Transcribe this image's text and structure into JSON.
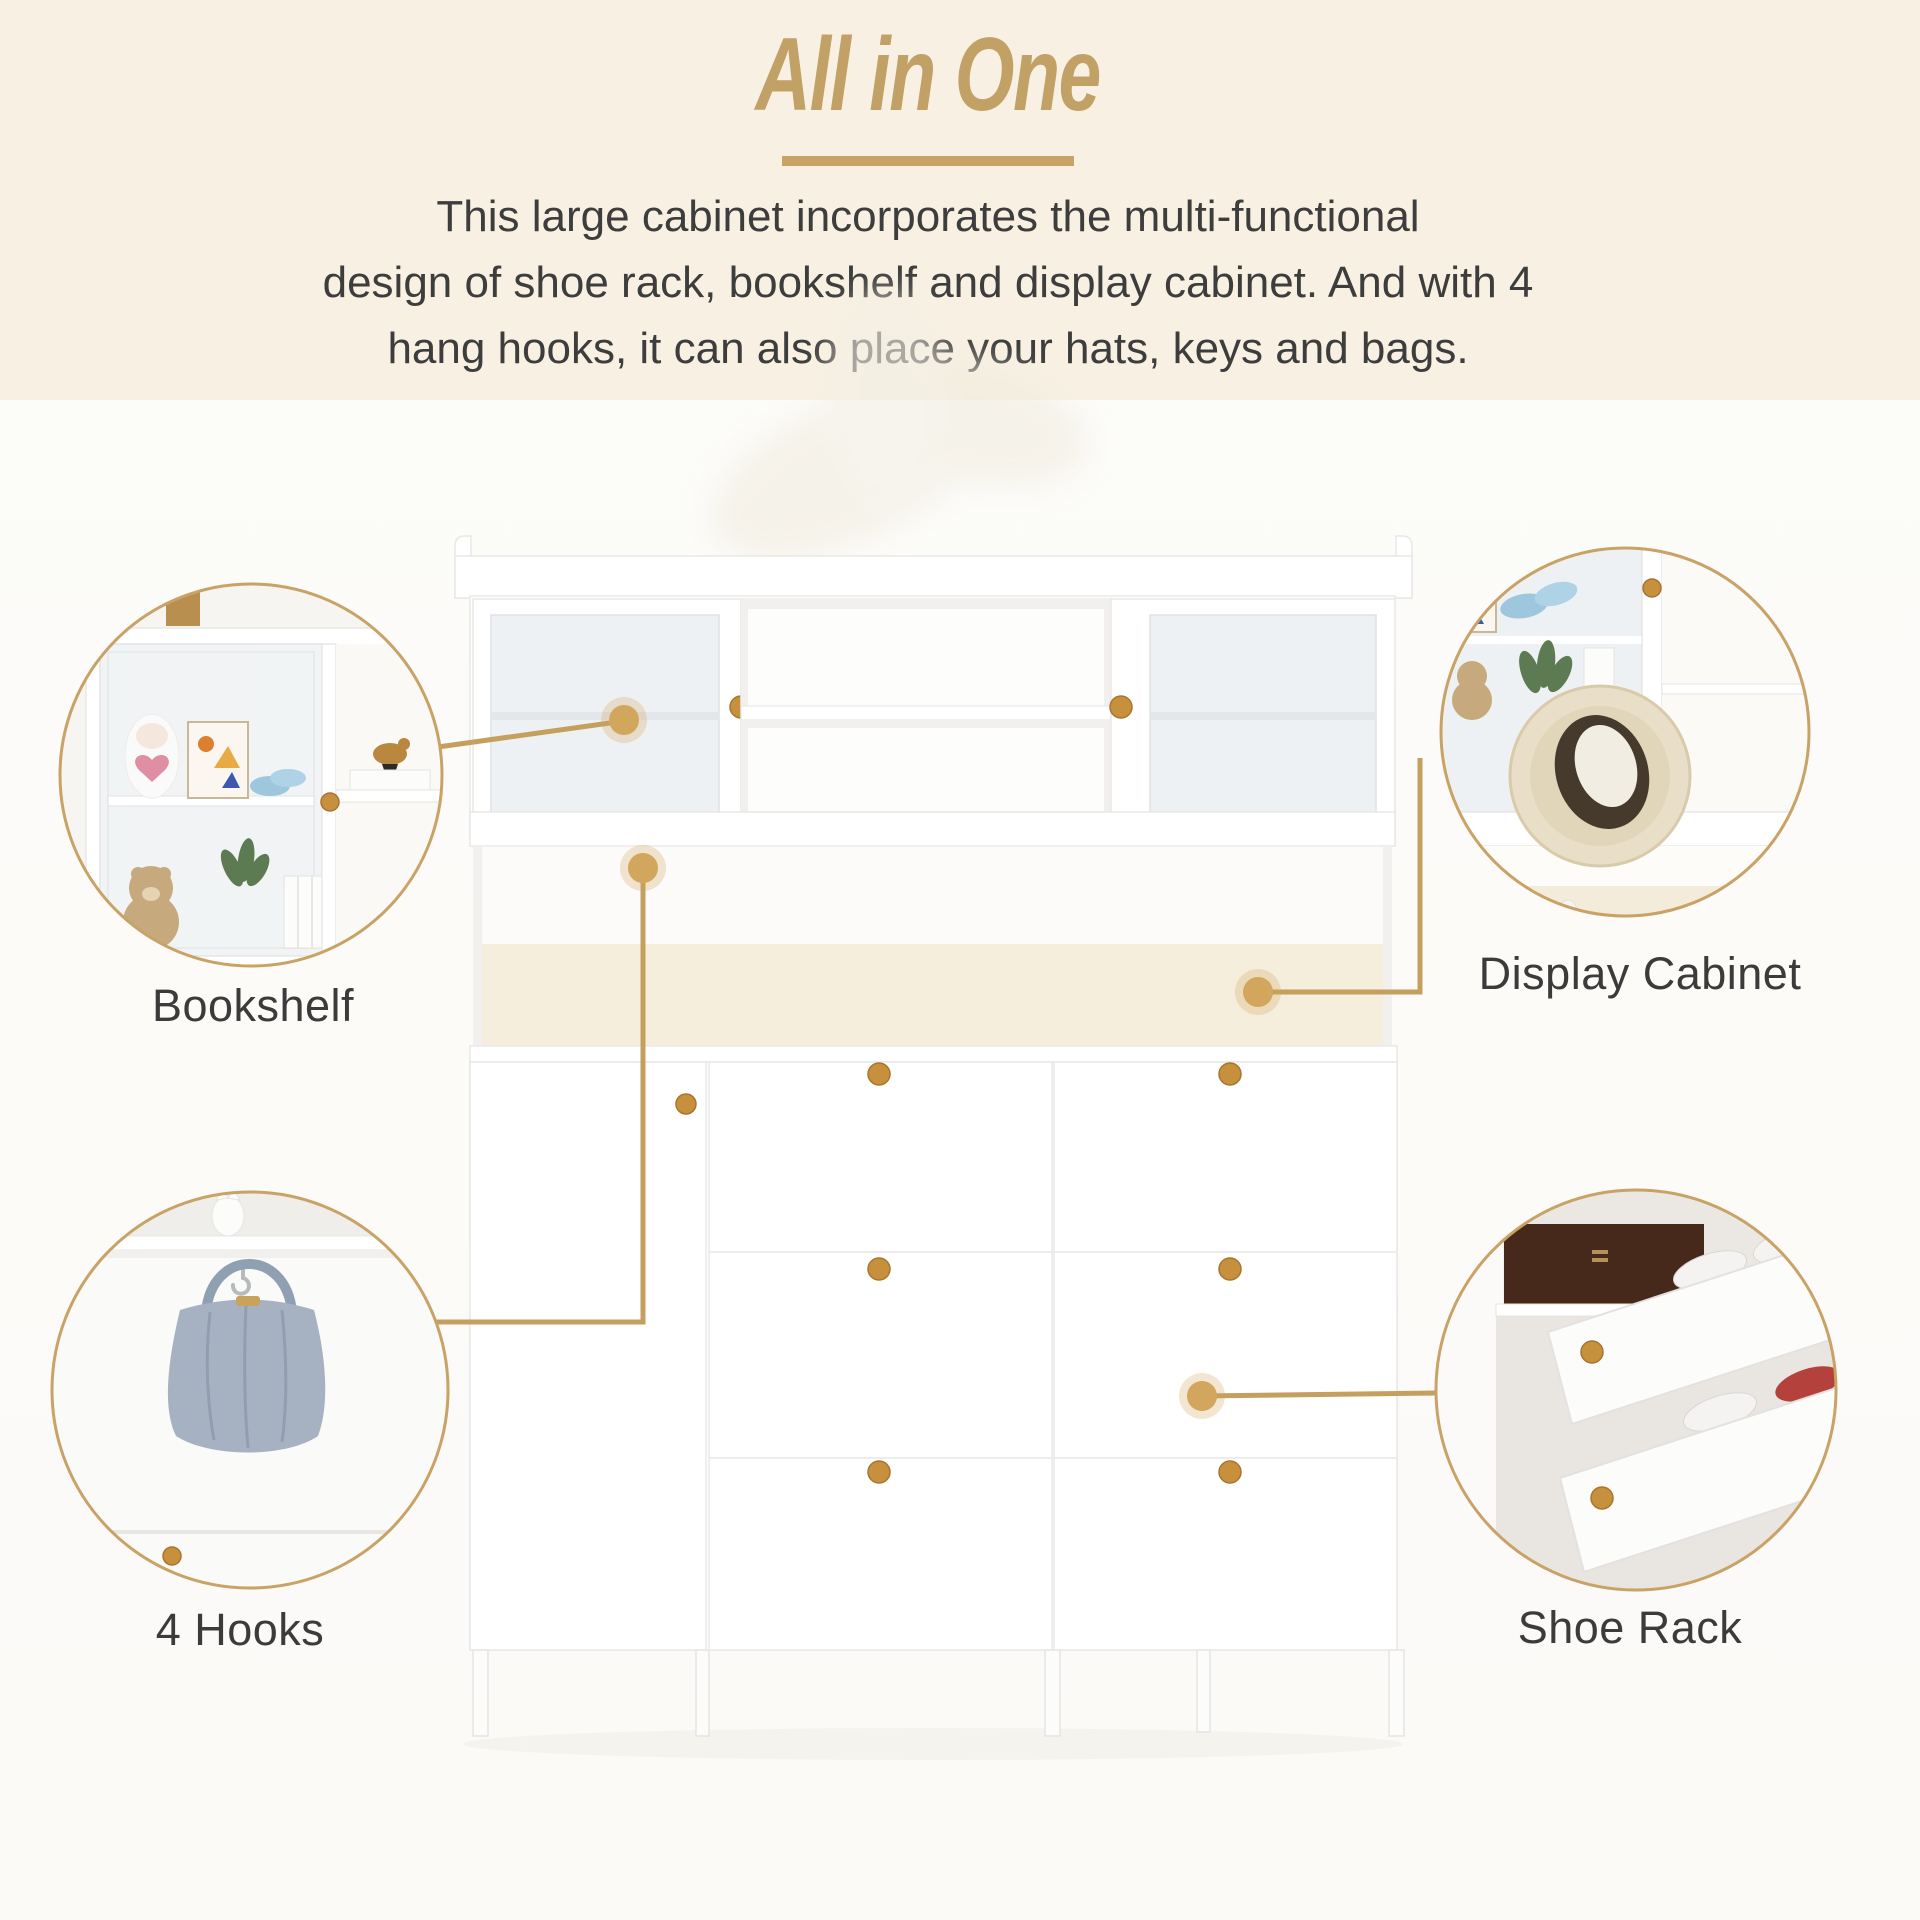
{
  "header": {
    "title": "All in One",
    "description_lines": [
      "This large cabinet incorporates the multi-functional",
      "design of shoe rack, bookshelf and display cabinet. And with 4",
      "hang hooks, it can also place your hats, keys and bags."
    ]
  },
  "callouts": {
    "bookshelf": {
      "label": "Bookshelf"
    },
    "display_cabinet": {
      "label": "Display Cabinet"
    },
    "hooks": {
      "label": "4 Hooks"
    },
    "shoe_rack": {
      "label": "Shoe Rack"
    }
  },
  "style": {
    "accent_gold": "#c2a167",
    "divider_gold": "#c9a266",
    "connector_gold": "#c59f5e",
    "header_background": "#f8f1e3",
    "body_text": "#3d3d3d",
    "label_text": "#3b3b3b",
    "knob_wood": "#c6903d",
    "cabinet_white": "#ffffff"
  }
}
